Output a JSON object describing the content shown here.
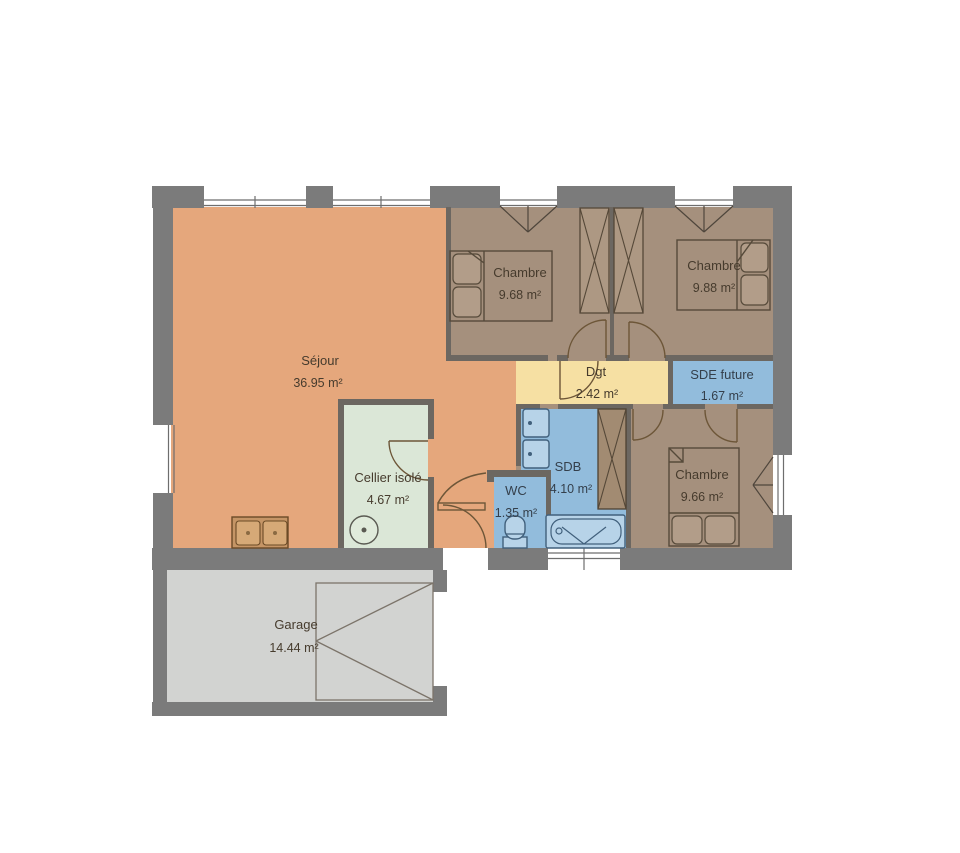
{
  "plan": {
    "title": "floor-plan",
    "rooms": [
      {
        "id": "sejour",
        "name": "Séjour",
        "area": "36.95 m²"
      },
      {
        "id": "chambre1",
        "name": "Chambre",
        "area": "9.68 m²"
      },
      {
        "id": "chambre2",
        "name": "Chambre",
        "area": "9.88 m²"
      },
      {
        "id": "chambre3",
        "name": "Chambre",
        "area": "9.66 m²"
      },
      {
        "id": "dgt",
        "name": "Dgt",
        "area": "2.42 m²"
      },
      {
        "id": "sde",
        "name": "SDE future",
        "area": "1.67 m²"
      },
      {
        "id": "sdb",
        "name": "SDB",
        "area": "4.10 m²"
      },
      {
        "id": "wc",
        "name": "WC",
        "area": "1.35 m²"
      },
      {
        "id": "cellier",
        "name": "Cellier isolé",
        "area": "4.67 m²"
      },
      {
        "id": "garage",
        "name": "Garage",
        "area": "14.44 m²"
      }
    ],
    "colors": {
      "sejour": "#e5a77c",
      "bedroom": "#a5907d",
      "dgt": "#f6e0a3",
      "wet": "#92bcdc",
      "cellier": "#dbe7d7",
      "garage": "#d2d3d1",
      "outer_wall": "#7b7b7b",
      "inner_wall": "#6c6761"
    }
  }
}
